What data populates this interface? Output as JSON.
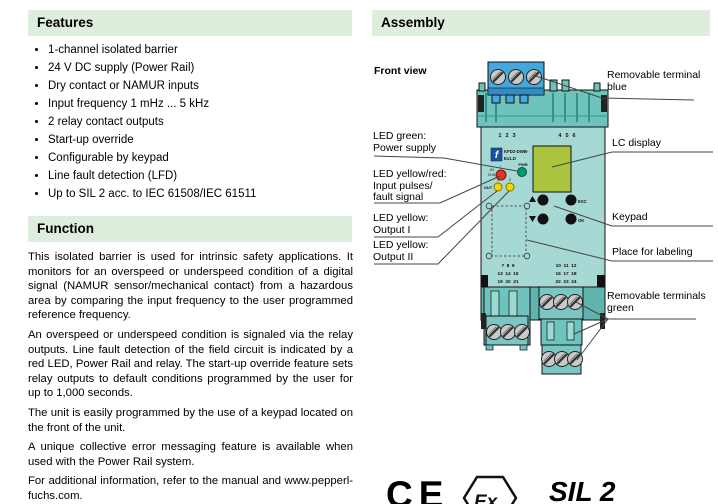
{
  "colors": {
    "header_bg": "#ddeedd",
    "device_body": "#6fc3bd",
    "device_face": "#a6d9d3",
    "terminal_blue": "#45a8dd",
    "lc_display": "#abc43f",
    "led_red": "#e63126",
    "led_green": "#00996e",
    "led_yellow": "#f6d800"
  },
  "features": {
    "title": "Features",
    "items": [
      "1-channel isolated barrier",
      "24 V DC supply (Power Rail)",
      "Dry contact or NAMUR inputs",
      "Input frequency 1 mHz ... 5 kHz",
      "2 relay contact outputs",
      "Start-up override",
      "Configurable by keypad",
      "Line fault detection (LFD)",
      "Up to SIL 2 acc. to IEC 61508/IEC 61511"
    ]
  },
  "function": {
    "title": "Function",
    "paragraphs": [
      "This isolated barrier is used for intrinsic safety applications. It monitors for an overspeed or underspeed condition of a digital signal (NAMUR sensor/mechanical contact) from a hazardous area by comparing the input frequency to the user programmed reference frequency.",
      "An overspeed or underspeed condition is signaled via the relay outputs. Line fault detection of the field circuit is indicated by a red LED, Power Rail and relay. The start-up override feature sets relay outputs to default conditions programmed by the user for up to 1,000 seconds.",
      "The unit is easily programmed by the use of a keypad located on the front of the unit.",
      "A unique collective error messaging feature is available when used with the Power Rail system.",
      "For additional information, refer to the manual and www.pepperl-fuchs.com."
    ]
  },
  "assembly": {
    "title": "Assembly",
    "front_view_label": "Front view",
    "callouts": {
      "led_green_l1": "LED green:",
      "led_green_l2": "Power supply",
      "led_yr_l1": "LED yellow/red:",
      "led_yr_l2": "Input pulses/",
      "led_yr_l3": "fault signal",
      "out1_l1": "LED yellow:",
      "out1_l2": "Output I",
      "out2_l1": "LED yellow:",
      "out2_l2": "Output II",
      "term_blue_l1": "Removable terminal",
      "term_blue_l2": "blue",
      "lc_display": "LC display",
      "keypad": "Keypad",
      "labeling": "Place for labeling",
      "term_green_l1": "Removable terminals",
      "term_green_l2": "green"
    },
    "device": {
      "top_left_numbers": "1 2 3",
      "top_right_numbers": "4 5 6",
      "model_l1": "KFD2-DWB-",
      "model_l2": "Ex1.D",
      "logo_letter": "f",
      "pwr": "PWR",
      "in_chk_l1": "IN",
      "in_chk_l2": "CHK",
      "led_in_no": "1",
      "out": "OUT",
      "led1": "1",
      "led2": "2",
      "esc": "ESC",
      "ok": "OK",
      "btm_left_rows": [
        "7 8 9",
        "13 14 15",
        "19 20 21"
      ],
      "btm_right_rows": [
        "10 11 12",
        "16 17 18",
        "22 23 24"
      ]
    },
    "marks": {
      "ce": "CE",
      "ex": "Ex",
      "sil": "SIL 2"
    }
  }
}
